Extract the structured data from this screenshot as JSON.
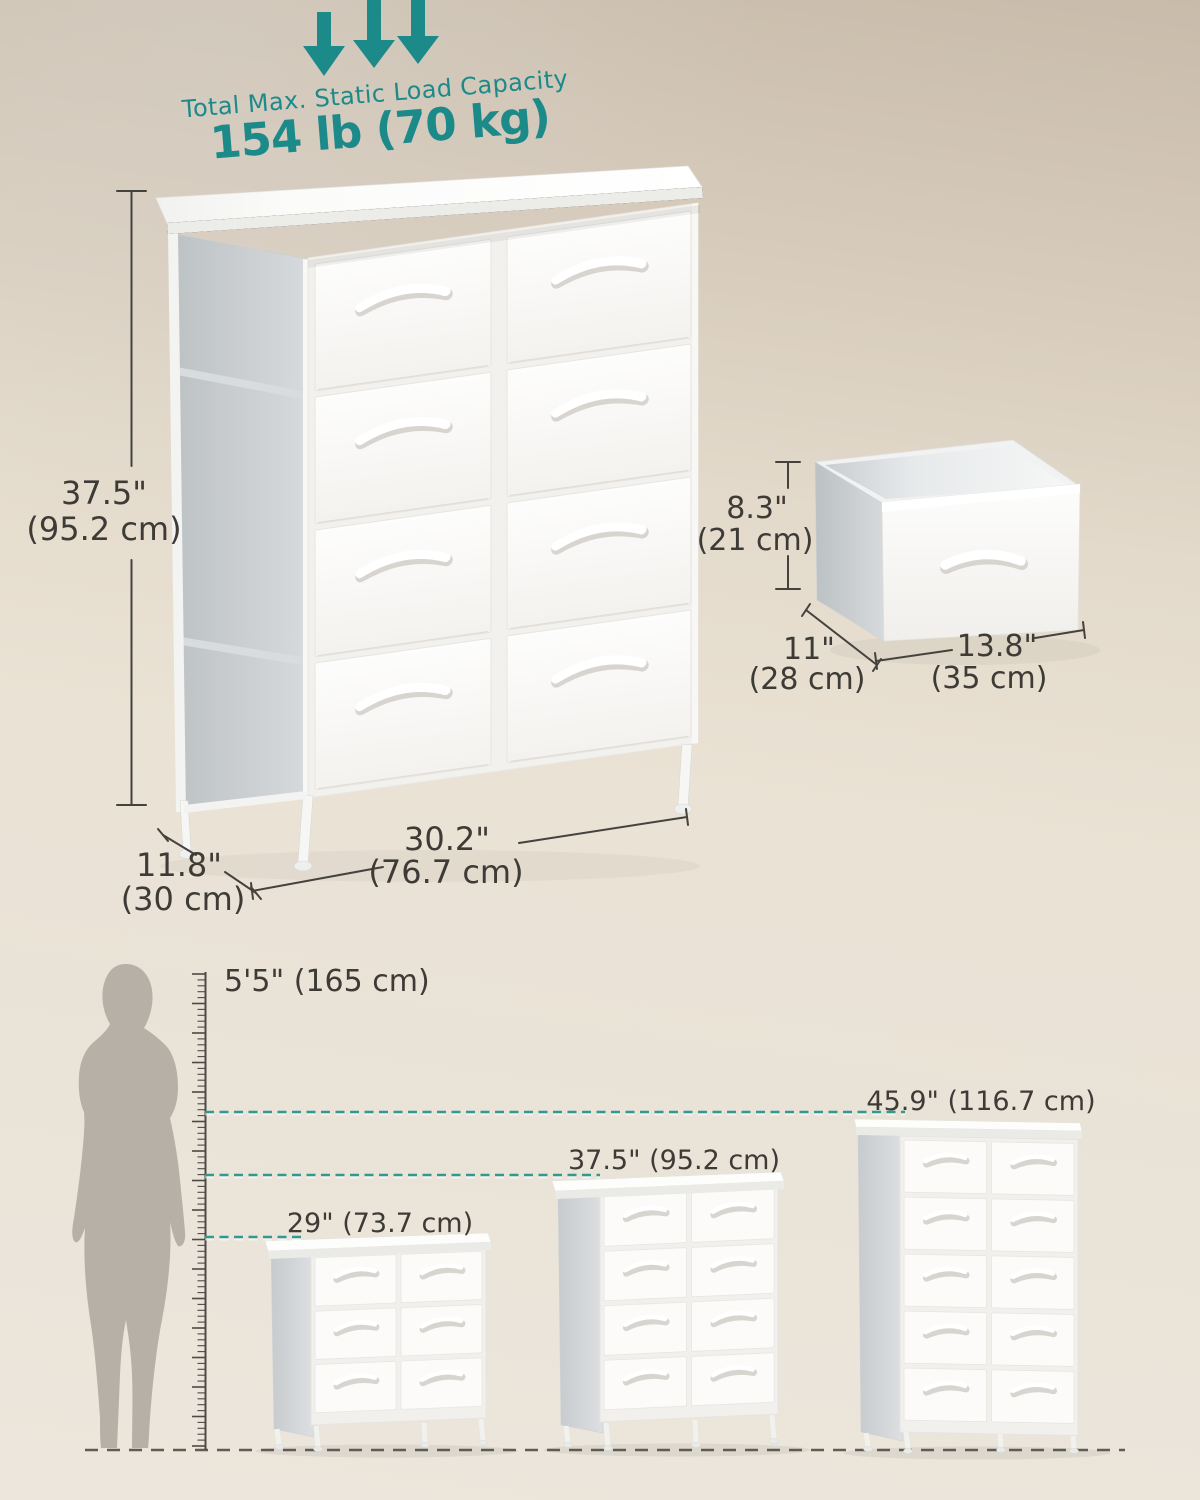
{
  "colors": {
    "accent_teal": "#1d8a8a",
    "dash_teal": "#339990",
    "dimension_text": "#3e3b37",
    "floor_dash": "#615c55"
  },
  "load_capacity": {
    "label": "Total Max. Static Load Capacity",
    "value": "154 lb (70 kg)"
  },
  "main_dresser": {
    "drawer_count": 8,
    "height_in": "37.5\"",
    "height_cm": "(95.2 cm)",
    "width_in": "30.2\"",
    "width_cm": "(76.7 cm)",
    "depth_in": "11.8\"",
    "depth_cm": "(30 cm)"
  },
  "single_drawer": {
    "height_in": "8.3\"",
    "height_cm": "(21 cm)",
    "depth_in": "11\"",
    "depth_cm": "(28 cm)",
    "width_in": "13.8\"",
    "width_cm": "(35 cm)"
  },
  "size_comparison": {
    "person_height": "5'5\" (165 cm)",
    "models": [
      {
        "label": "29\" (73.7 cm)",
        "drawer_count": 6
      },
      {
        "label": "37.5\" (95.2 cm)",
        "drawer_count": 8
      },
      {
        "label": "45.9\" (116.7 cm)",
        "drawer_count": 10
      }
    ]
  }
}
